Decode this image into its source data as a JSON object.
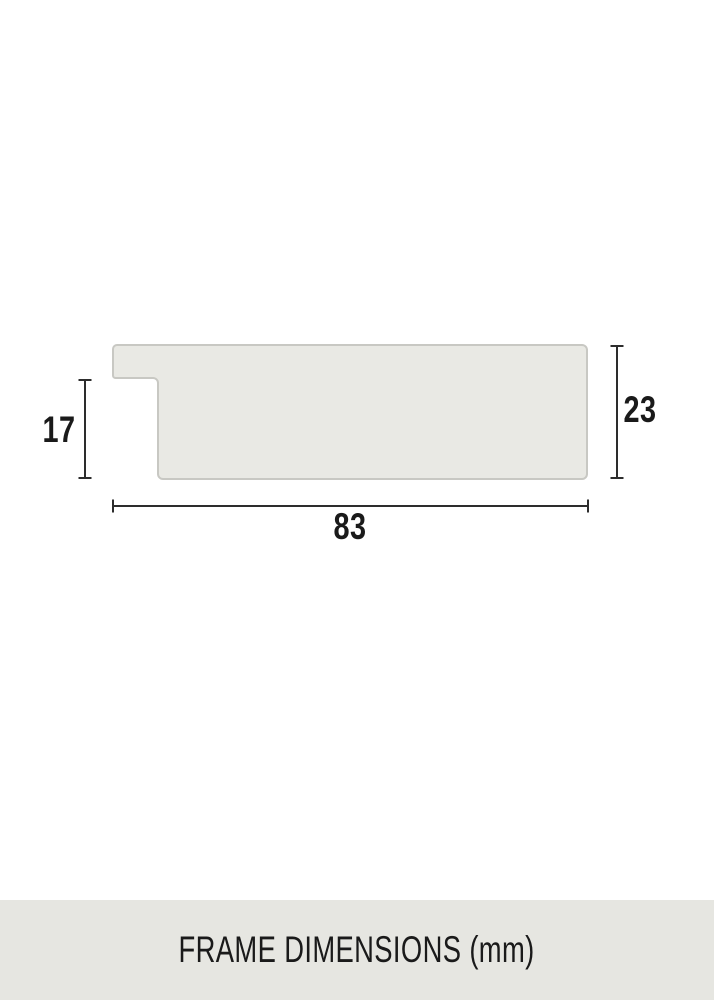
{
  "diagram": {
    "rabbet_height_label": "17",
    "total_height_label": "23",
    "total_width_label": "83"
  },
  "caption": {
    "text": "FRAME DIMENSIONS (mm)"
  },
  "colors": {
    "background": "#ffffff",
    "profile_fill": "#e9e9e4",
    "profile_stroke": "#c8c8c3",
    "dimension_line": "#2d2d2d",
    "label_text": "#1a1a1a",
    "caption_bar_background": "#e6e6e1",
    "caption_text": "#1a1a1a"
  }
}
